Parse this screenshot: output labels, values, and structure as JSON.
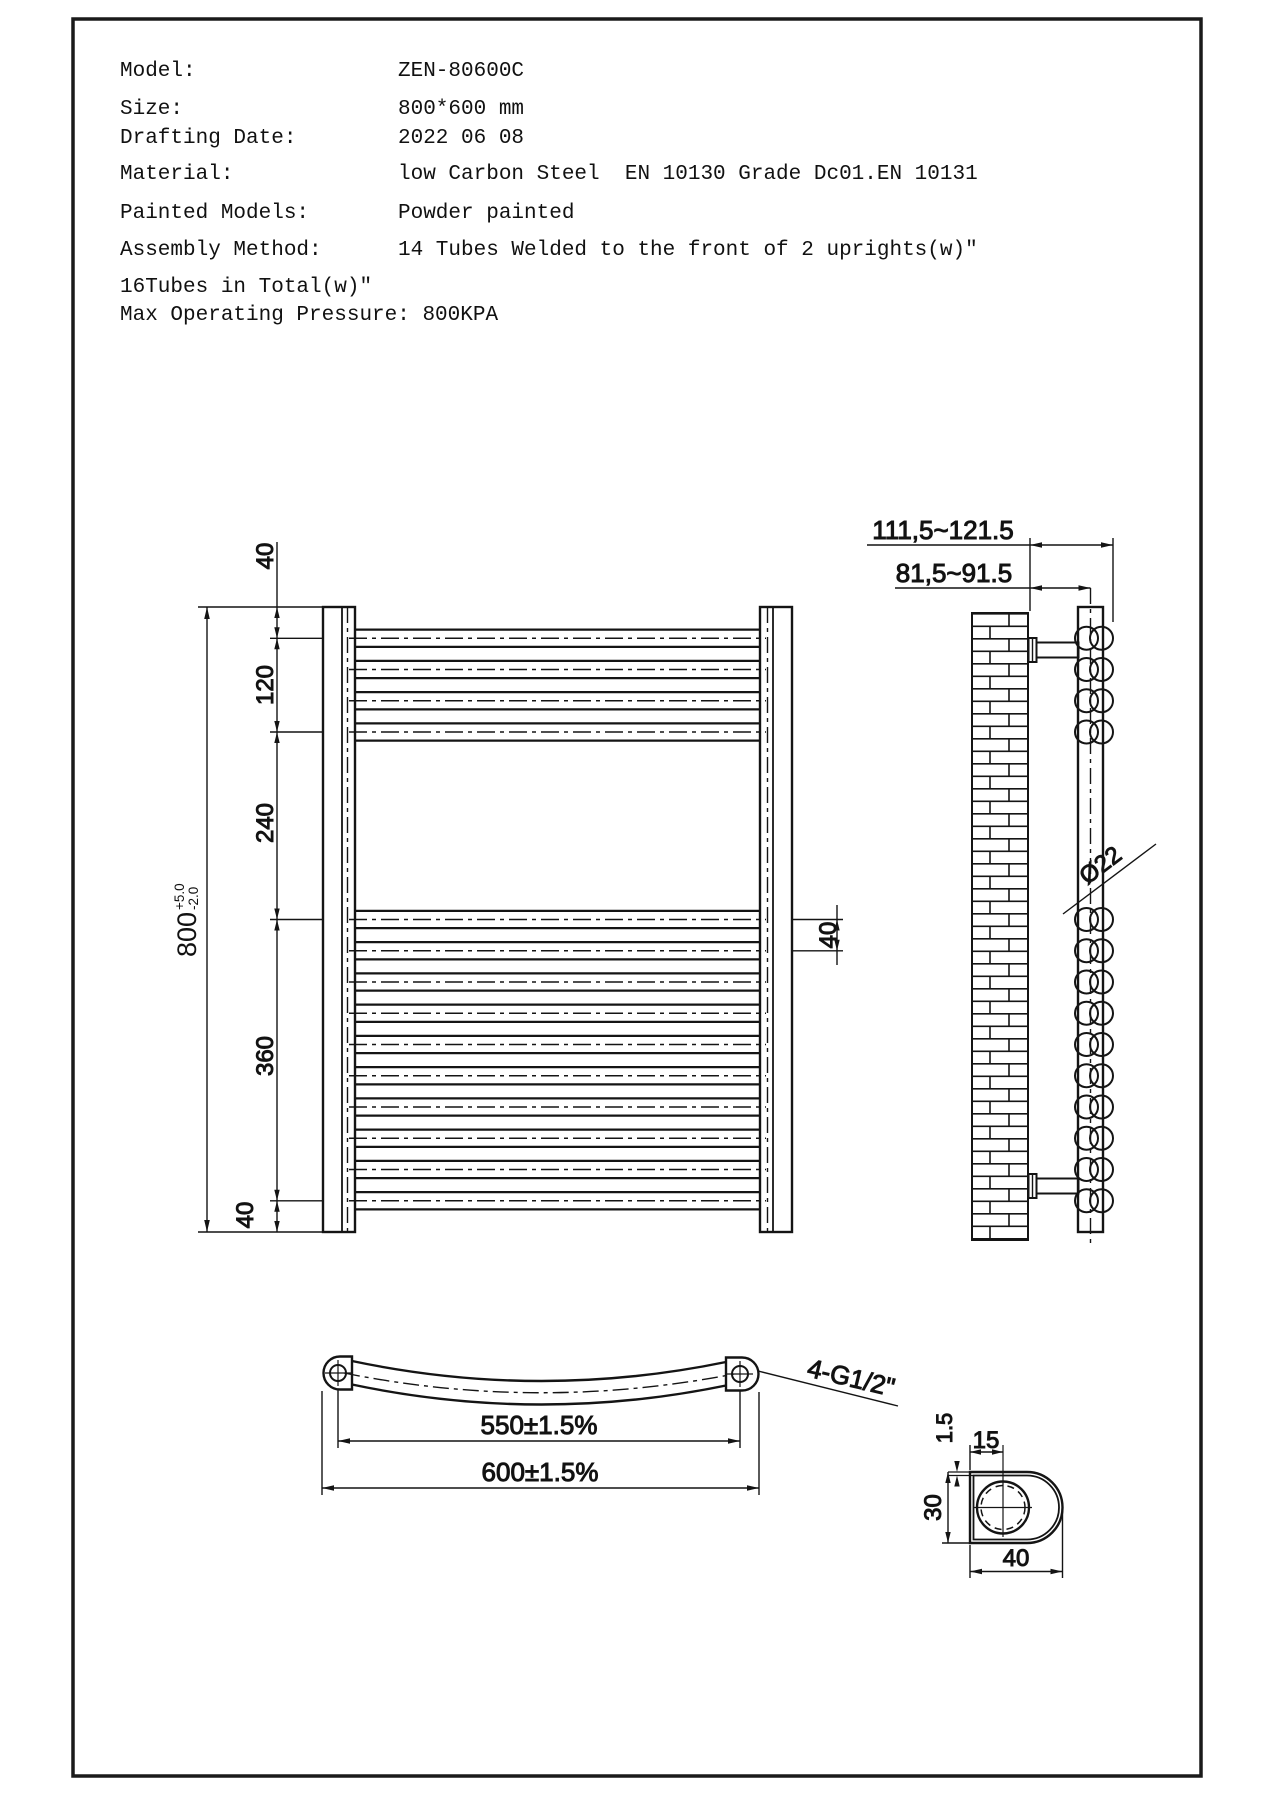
{
  "header": {
    "rows": [
      {
        "label": "Model:",
        "value": "ZEN-80600C"
      },
      {
        "label": "Size:",
        "value": "800*600 mm"
      },
      {
        "label": "Drafting Date:",
        "value": "2022 06 08"
      },
      {
        "label": "Material:",
        "value": "low Carbon Steel  EN 10130 Grade Dc01.EN 10131"
      },
      {
        "label": "Painted Models:",
        "value": "Powder painted"
      },
      {
        "label": "Assembly Method:",
        "value": "14 Tubes Welded to the front of 2 uprights(w)\""
      }
    ],
    "notes": [
      "16Tubes in Total(w)\"",
      "Max Operating Pressure: 800KPA"
    ]
  },
  "front_view": {
    "dim_overall": "800",
    "dim_tol_plus": "+5.0",
    "dim_tol_minus": "-2.0",
    "dim_top": "40",
    "dim_upper_group": "120",
    "dim_middle_gap": "240",
    "dim_lower_group": "360",
    "dim_bottom": "40",
    "dim_tube_pitch": "40"
  },
  "side_view": {
    "dim_wall_to_outer": "111,5~121.5",
    "dim_wall_to_center": "81,5~91.5",
    "dim_tube_diameter": "Ø22"
  },
  "bottom_view": {
    "dim_hole_centers": "550±1.5%",
    "dim_overall_width": "600±1.5%",
    "label_connections": "4-G1/2\""
  },
  "detail_view": {
    "dim_wall_thickness": "1.5",
    "dim_center_offset": "15",
    "dim_profile_height": "30",
    "dim_profile_width": "40"
  }
}
